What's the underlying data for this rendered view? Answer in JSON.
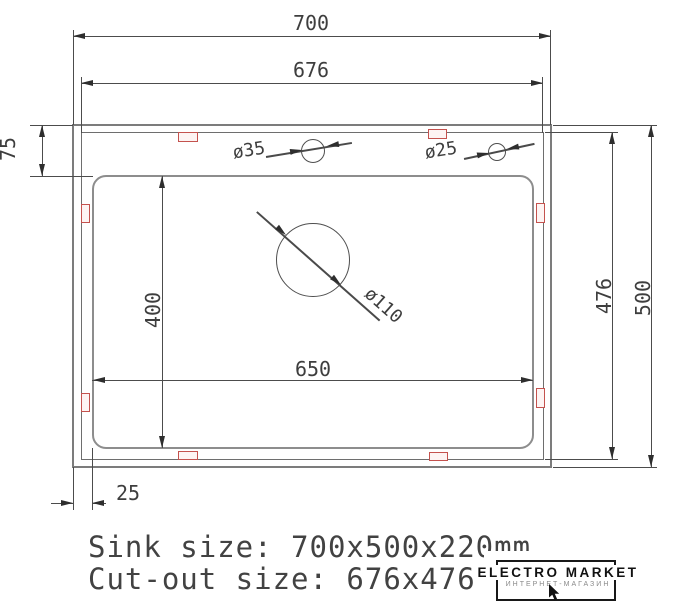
{
  "drawing": {
    "dims": {
      "sink_width": "700",
      "cutout_width": "676",
      "deck_height": "75",
      "bowl_height": "400",
      "bowl_width": "650",
      "cutout_height": "476",
      "sink_height": "500",
      "edge_offset": "25"
    },
    "holes": {
      "faucet_hole": "ø35",
      "accessory_hole": "ø25",
      "drain_hole": "ø110"
    }
  },
  "footer": {
    "sink_size_line": "Sink size: 700x500x220mm",
    "cutout_size_line": "Cut-out size: 676x476"
  },
  "logo": {
    "title": "ELECTRO MARKET",
    "subtitle": "ИНТЕРНЕТ-МАГАЗИН"
  },
  "colors": {
    "line": "#4c4c4c",
    "structure": "#7c7c7c",
    "clip": "#c4524e",
    "logo_text": "#111111"
  }
}
